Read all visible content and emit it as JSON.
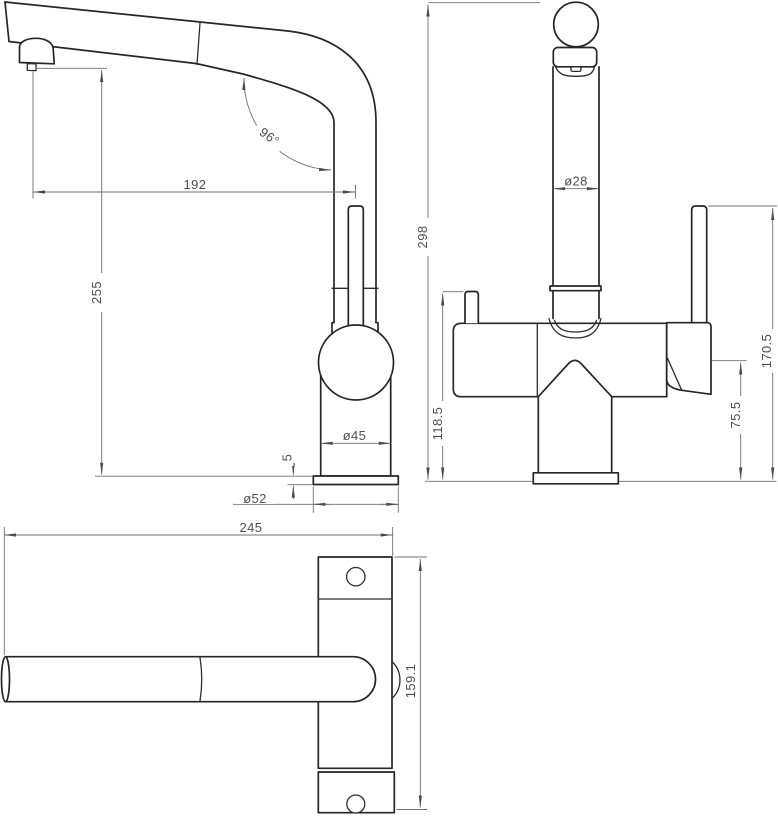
{
  "drawing": {
    "type": "faucet-orthographic-technical-drawing",
    "background": "#ffffff",
    "outline_color": "#262626",
    "dimension_line_color": "#6f6f6f",
    "text_color": "#4e4e4e",
    "dims": {
      "spout_reach": "192",
      "spout_outlet_height": "255",
      "spout_angle": "96°",
      "body_diameter": "ø45",
      "base_plate_thickness": "5",
      "base_diameter": "ø52",
      "total_height": "298",
      "pipe_diameter": "ø28",
      "left_lever_height": "118.5",
      "handle_base_height": "75.5",
      "handle_lever_height": "170.5",
      "overall_length": "245",
      "overall_depth": "159.1"
    }
  }
}
